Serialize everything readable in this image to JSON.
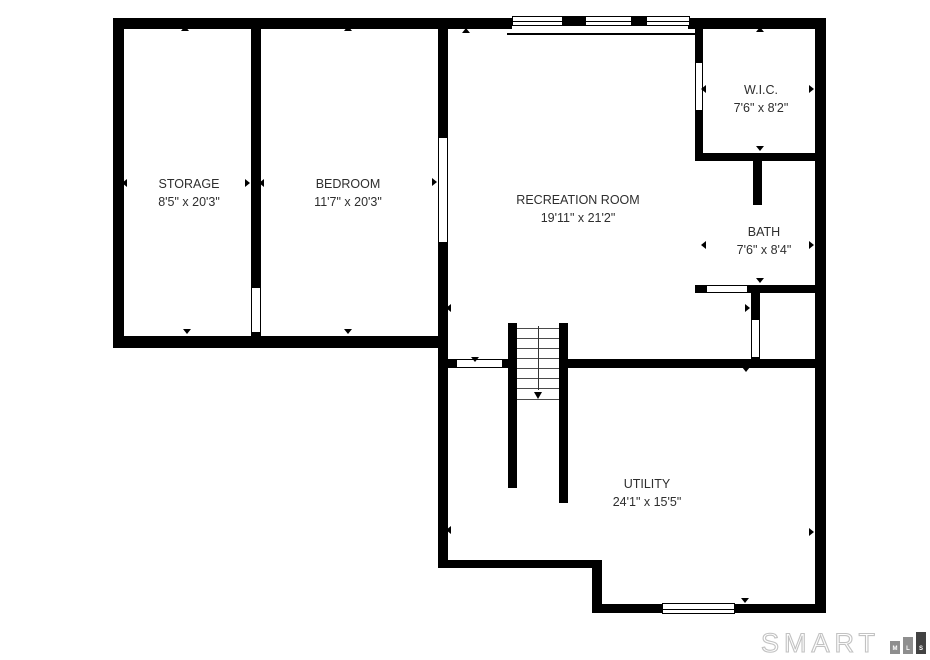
{
  "canvas": {
    "width": 930,
    "height": 660,
    "background": "#ffffff",
    "wall_color": "#000000",
    "text_color": "#2e2e2e"
  },
  "rooms": [
    {
      "id": "storage",
      "name": "STORAGE",
      "dimensions": "8'5\" x 20'3\"",
      "cx": 189,
      "cy": 193
    },
    {
      "id": "bedroom",
      "name": "BEDROOM",
      "dimensions": "11'7\" x 20'3\"",
      "cx": 348,
      "cy": 193
    },
    {
      "id": "recreation-room",
      "name": "RECREATION ROOM",
      "dimensions": "19'11\" x 21'2\"",
      "cx": 578,
      "cy": 209
    },
    {
      "id": "wic",
      "name": "W.I.C.",
      "dimensions": "7'6\" x 8'2\"",
      "cx": 761,
      "cy": 99
    },
    {
      "id": "bath",
      "name": "BATH",
      "dimensions": "7'6\" x 8'4\"",
      "cx": 764,
      "cy": 241
    },
    {
      "id": "utility",
      "name": "UTILITY",
      "dimensions": "24'1\" x 15'5\"",
      "cx": 647,
      "cy": 493
    }
  ],
  "plan": {
    "walls": [
      {
        "name": "outer-top-left",
        "x": 113,
        "y": 18,
        "w": 399,
        "h": 11
      },
      {
        "name": "outer-top-right",
        "x": 688,
        "y": 18,
        "w": 138,
        "h": 11
      },
      {
        "name": "outer-left",
        "x": 113,
        "y": 18,
        "w": 11,
        "h": 330
      },
      {
        "name": "outer-right",
        "x": 815,
        "y": 18,
        "w": 11,
        "h": 595
      },
      {
        "name": "storage-bedroom-divider-upper",
        "x": 251,
        "y": 29,
        "w": 10,
        "h": 259
      },
      {
        "name": "storage-bedroom-divider-lower",
        "x": 251,
        "y": 332,
        "w": 10,
        "h": 14
      },
      {
        "name": "storage-bedroom-bottom",
        "x": 113,
        "y": 336,
        "w": 335,
        "h": 12
      },
      {
        "name": "bedroom-rec-divider-upper",
        "x": 438,
        "y": 29,
        "w": 10,
        "h": 109
      },
      {
        "name": "bedroom-rec-divider-lower",
        "x": 438,
        "y": 242,
        "w": 10,
        "h": 326
      },
      {
        "name": "wic-west-upper",
        "x": 695,
        "y": 29,
        "w": 8,
        "h": 34
      },
      {
        "name": "wic-west-lower",
        "x": 695,
        "y": 110,
        "w": 8,
        "h": 50
      },
      {
        "name": "wic-bath-divider",
        "x": 695,
        "y": 153,
        "w": 131,
        "h": 8
      },
      {
        "name": "bath-interior-stub",
        "x": 753,
        "y": 161,
        "w": 9,
        "h": 44
      },
      {
        "name": "bath-south-west-stub",
        "x": 695,
        "y": 285,
        "w": 12,
        "h": 8
      },
      {
        "name": "bath-south",
        "x": 747,
        "y": 285,
        "w": 68,
        "h": 8
      },
      {
        "name": "hall-divider-upper",
        "x": 751,
        "y": 293,
        "w": 9,
        "h": 27
      },
      {
        "name": "hall-divider-lower",
        "x": 751,
        "y": 357,
        "w": 9,
        "h": 11
      },
      {
        "name": "rec-south-west-stub",
        "x": 448,
        "y": 359,
        "w": 9,
        "h": 9
      },
      {
        "name": "rec-south-mid-stub",
        "x": 502,
        "y": 359,
        "w": 6,
        "h": 9
      },
      {
        "name": "rec-south-east",
        "x": 568,
        "y": 359,
        "w": 247,
        "h": 9
      },
      {
        "name": "stair-west",
        "x": 508,
        "y": 323,
        "w": 9,
        "h": 165
      },
      {
        "name": "stair-east",
        "x": 559,
        "y": 323,
        "w": 9,
        "h": 180
      },
      {
        "name": "utility-south-west",
        "x": 438,
        "y": 560,
        "w": 164,
        "h": 8
      },
      {
        "name": "utility-step",
        "x": 592,
        "y": 560,
        "w": 10,
        "h": 53
      },
      {
        "name": "outer-bottom",
        "x": 592,
        "y": 604,
        "w": 234,
        "h": 9
      },
      {
        "name": "window-separator-1",
        "x": 563,
        "y": 16,
        "w": 22,
        "h": 10
      },
      {
        "name": "window-separator-2",
        "x": 632,
        "y": 16,
        "w": 14,
        "h": 10
      }
    ],
    "lines": [
      {
        "name": "window-bay-inner-face",
        "x": 507,
        "y": 33,
        "w": 190,
        "h": 2
      }
    ],
    "openings": [
      {
        "name": "storage-bedroom-door",
        "x": 251,
        "y": 288,
        "w": 10,
        "h": 44,
        "orient": "v"
      },
      {
        "name": "bedroom-rec-opening",
        "x": 438,
        "y": 138,
        "w": 10,
        "h": 104,
        "orient": "v"
      },
      {
        "name": "wic-door",
        "x": 695,
        "y": 63,
        "w": 8,
        "h": 47,
        "orient": "v"
      },
      {
        "name": "bath-door",
        "x": 707,
        "y": 285,
        "w": 40,
        "h": 8,
        "orient": "h"
      },
      {
        "name": "hall-door",
        "x": 751,
        "y": 320,
        "w": 9,
        "h": 37,
        "orient": "v"
      },
      {
        "name": "rec-utility-door",
        "x": 457,
        "y": 359,
        "w": 45,
        "h": 9,
        "orient": "h"
      }
    ],
    "windows": [
      {
        "name": "rec-window-1",
        "x": 512,
        "y": 16,
        "w": 51,
        "h": 10
      },
      {
        "name": "rec-window-2",
        "x": 585,
        "y": 16,
        "w": 47,
        "h": 10
      },
      {
        "name": "rec-window-3",
        "x": 646,
        "y": 16,
        "w": 44,
        "h": 10
      },
      {
        "name": "utility-window",
        "x": 662,
        "y": 603,
        "w": 73,
        "h": 11
      }
    ],
    "stairs": {
      "x": 517,
      "w": 42,
      "tread_ys": [
        328,
        338,
        348,
        358,
        368,
        378,
        388,
        399
      ],
      "center_x": 538,
      "line_y1": 326,
      "line_y2": 390,
      "arrow": {
        "x": 538,
        "y": 392
      }
    },
    "ticks": [
      {
        "x": 185,
        "y": 30,
        "dir": "up"
      },
      {
        "x": 348,
        "y": 30,
        "dir": "up"
      },
      {
        "x": 466,
        "y": 32,
        "dir": "up"
      },
      {
        "x": 760,
        "y": 31,
        "dir": "up"
      },
      {
        "x": 126,
        "y": 183,
        "dir": "left"
      },
      {
        "x": 249,
        "y": 183,
        "dir": "right"
      },
      {
        "x": 263,
        "y": 183,
        "dir": "left"
      },
      {
        "x": 187,
        "y": 333,
        "dir": "down"
      },
      {
        "x": 348,
        "y": 333,
        "dir": "down"
      },
      {
        "x": 436,
        "y": 182,
        "dir": "right"
      },
      {
        "x": 450,
        "y": 308,
        "dir": "left"
      },
      {
        "x": 475,
        "y": 361,
        "dir": "down"
      },
      {
        "x": 705,
        "y": 89,
        "dir": "left"
      },
      {
        "x": 813,
        "y": 89,
        "dir": "right"
      },
      {
        "x": 760,
        "y": 150,
        "dir": "down"
      },
      {
        "x": 705,
        "y": 245,
        "dir": "left"
      },
      {
        "x": 813,
        "y": 245,
        "dir": "right"
      },
      {
        "x": 760,
        "y": 282,
        "dir": "down"
      },
      {
        "x": 749,
        "y": 308,
        "dir": "right"
      },
      {
        "x": 746,
        "y": 371,
        "dir": "down"
      },
      {
        "x": 450,
        "y": 530,
        "dir": "left"
      },
      {
        "x": 813,
        "y": 532,
        "dir": "right"
      },
      {
        "x": 745,
        "y": 602,
        "dir": "down"
      }
    ]
  },
  "logo": {
    "text": "SMART",
    "bars": [
      {
        "letter": "M",
        "height": 13,
        "color": "#8e8e8e"
      },
      {
        "letter": "L",
        "height": 17,
        "color": "#8e8e8e"
      },
      {
        "letter": "S",
        "height": 22,
        "color": "#424242"
      }
    ]
  }
}
